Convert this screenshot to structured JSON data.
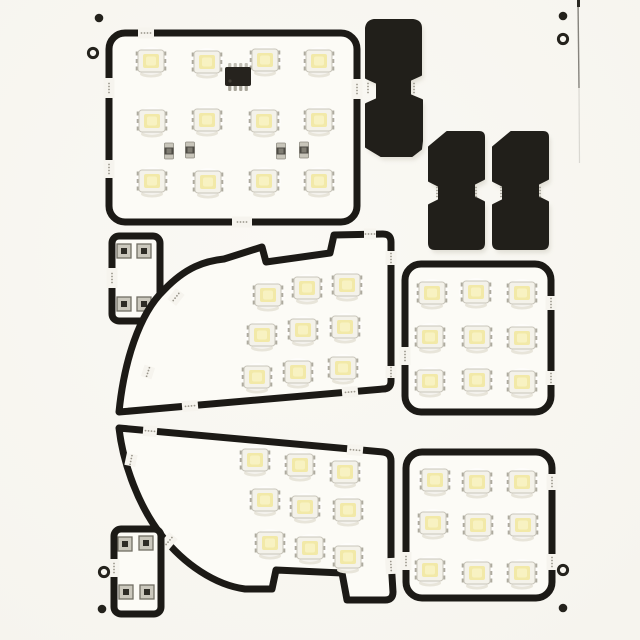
{
  "image": {
    "kind": "product-photo",
    "caption": "White snap-apart PCB panel of car interior LED light boards: black outline traces, white SMD 5050 LEDs with pale yellow phosphor, driver IC, resistors, black festoon adapters and fiducial marks",
    "led_total": 48
  },
  "palette": {
    "background": "#f6f4ee",
    "background_hi": "#faf9f4",
    "board_surface": "#fcfbf6",
    "outline": "#1c1a16",
    "solid_piece": "#211f1a",
    "led_body": "#f4f2ea",
    "led_border": "#c9c6bb",
    "led_phosphor": "#f2e9a8",
    "led_phosphor_hi": "#f8f2c2",
    "led_pad": "#aeab9f",
    "led_shadow": "#e8e5da",
    "ic_body": "#26231e",
    "pin_metal": "#a8a59a",
    "resistor_cap": "#c8c5ba",
    "resistor_body": "#4e4c45",
    "resistor_dot": "#807d73",
    "pad_face": "#cbc8bd",
    "pad_edge": "#716e64",
    "pad_center": "#2e2c26",
    "bite_dot": "#9a968b",
    "fiducial": "#24221c",
    "shadow_soft": "#dcd9cf",
    "edge_line": "#55534c"
  },
  "scene": {
    "width": 640,
    "height": 640,
    "boards": [
      {
        "id": "map-light-board",
        "rect": [
          109,
          33,
          248,
          189,
          16
        ],
        "breaks": [
          [
            146,
            33,
            0,
            16
          ],
          [
            109,
            88,
            90,
            20
          ],
          [
            109,
            169,
            90,
            18
          ],
          [
            242,
            222,
            0,
            20
          ],
          [
            357,
            89,
            90,
            20
          ]
        ],
        "leds": [
          [
            151,
            61
          ],
          [
            207,
            62
          ],
          [
            265,
            60
          ],
          [
            319,
            61
          ],
          [
            152,
            121
          ],
          [
            207,
            120
          ],
          [
            264,
            121
          ],
          [
            319,
            120
          ],
          [
            152,
            181
          ],
          [
            208,
            182
          ],
          [
            264,
            181
          ],
          [
            319,
            181
          ]
        ],
        "ics": [
          [
            238,
            77
          ]
        ],
        "resistors": [
          [
            169,
            151
          ],
          [
            190,
            150
          ],
          [
            281,
            151
          ],
          [
            304,
            150
          ]
        ]
      },
      {
        "id": "jumper-board-top",
        "rect": [
          112,
          236,
          48,
          85,
          7
        ],
        "breaks": [
          [
            112,
            278,
            90,
            20
          ]
        ],
        "pads": [
          [
            124,
            251
          ],
          [
            144,
            251
          ],
          [
            124,
            304
          ],
          [
            144,
            304
          ]
        ]
      },
      {
        "id": "dome-board-upper",
        "path": "M 119,412 C 124,362 139,314 164,290 C 186,267 205,261 224,259 L 262,247 L 266,262 L 330,253 L 334,235 L 383,234 Q 391,234 391,242 L 391,381 Q 391,389 383,389 Z",
        "breaks": [
          [
            176,
            297,
            -52,
            14
          ],
          [
            148,
            372,
            -72,
            12
          ],
          [
            190,
            406,
            -5,
            16
          ],
          [
            350,
            392,
            -5,
            16
          ],
          [
            391,
            258,
            90,
            14
          ],
          [
            391,
            372,
            90,
            12
          ],
          [
            370,
            234,
            0,
            12
          ]
        ],
        "leds": [
          [
            268,
            295
          ],
          [
            307,
            288
          ],
          [
            347,
            285
          ],
          [
            262,
            335
          ],
          [
            303,
            330
          ],
          [
            345,
            327
          ],
          [
            257,
            377
          ],
          [
            298,
            372
          ],
          [
            343,
            368
          ]
        ]
      },
      {
        "id": "dome-board-lower",
        "path": "M 119,428 L 383,452 Q 391,453 391,461 L 391,560 L 393,592 Q 393,600 385,600 L 347,600 L 342,573 L 276,570 L 272,589 L 245,589 C 215,585 184,564 162,536 C 139,507 123,464 119,428 Z",
        "breaks": [
          [
            150,
            431,
            5,
            14
          ],
          [
            355,
            450,
            5,
            16
          ],
          [
            391,
            566,
            87,
            16
          ],
          [
            169,
            541,
            -50,
            14
          ],
          [
            131,
            460,
            -78,
            12
          ]
        ],
        "leds": [
          [
            255,
            460
          ],
          [
            300,
            465
          ],
          [
            345,
            472
          ],
          [
            265,
            500
          ],
          [
            305,
            507
          ],
          [
            348,
            510
          ],
          [
            270,
            543
          ],
          [
            310,
            548
          ],
          [
            348,
            557
          ]
        ]
      },
      {
        "id": "square-led-board-right",
        "rect": [
          405,
          264,
          146,
          148,
          16
        ],
        "breaks": [
          [
            405,
            356,
            90,
            18
          ],
          [
            551,
            303,
            90,
            14
          ],
          [
            551,
            378,
            90,
            14
          ]
        ],
        "leds": [
          [
            432,
            293
          ],
          [
            476,
            292
          ],
          [
            522,
            293
          ],
          [
            430,
            337
          ],
          [
            477,
            337
          ],
          [
            522,
            338
          ],
          [
            430,
            381
          ],
          [
            477,
            380
          ],
          [
            522,
            382
          ]
        ]
      },
      {
        "id": "square-led-board-bottom-right",
        "rect": [
          406,
          452,
          146,
          146,
          16
        ],
        "breaks": [
          [
            406,
            561,
            90,
            18
          ],
          [
            552,
            482,
            90,
            16
          ],
          [
            552,
            562,
            90,
            16
          ]
        ],
        "leds": [
          [
            435,
            480
          ],
          [
            477,
            482
          ],
          [
            522,
            482
          ],
          [
            433,
            523
          ],
          [
            478,
            525
          ],
          [
            523,
            525
          ],
          [
            430,
            570
          ],
          [
            477,
            573
          ],
          [
            522,
            573
          ]
        ]
      },
      {
        "id": "jumper-board-bottom",
        "rect": [
          114,
          529,
          47,
          85,
          7
        ],
        "breaks": [
          [
            114,
            568,
            90,
            18
          ]
        ],
        "pads": [
          [
            125,
            544
          ],
          [
            146,
            543
          ],
          [
            126,
            592
          ],
          [
            147,
            592
          ]
        ]
      }
    ],
    "solid_pieces": [
      {
        "id": "festoon-adapter-top",
        "path": "M 374,20 L 413,20 Q 421,21 421,28 L 421,75 L 410,80 L 410,95 L 422,100 L 422,141 L 421,149 L 412,156 L 381,156 L 366,147 L 366,104 L 377,99 L 377,83 L 366,78 L 366,28 Q 367,21 374,20 Z",
        "bites": [
          [
            368,
            88,
            90
          ],
          [
            414,
            88,
            90
          ]
        ]
      },
      {
        "id": "wedge-adapter-left",
        "path": "M 447,132 L 479,132 Q 484,132 484,137 L 484,179 L 474,184 L 474,197 L 484,202 L 484,243 Q 484,249 478,249 L 435,249 Q 429,249 429,243 L 429,205 L 439,200 L 439,186 L 429,181 L 429,147 Z",
        "bites": [
          [
            437,
            192,
            90
          ],
          [
            476,
            192,
            90
          ]
        ]
      },
      {
        "id": "wedge-adapter-right",
        "path": "M 511,132 L 543,132 Q 548,132 548,137 L 548,179 L 538,184 L 538,197 L 548,202 L 548,243 Q 548,249 542,249 L 499,249 Q 493,249 493,243 L 493,205 L 503,200 L 503,186 L 493,181 L 493,147 Z",
        "bites": [
          [
            501,
            192,
            90
          ],
          [
            540,
            192,
            90
          ]
        ]
      }
    ],
    "fiducials": {
      "solid": [
        [
          99,
          18
        ],
        [
          563,
          16
        ],
        [
          102,
          609
        ],
        [
          563,
          608
        ]
      ],
      "ring": [
        [
          93,
          53
        ],
        [
          563,
          39
        ],
        [
          104,
          572
        ],
        [
          563,
          570
        ]
      ]
    },
    "edge_marks": {
      "line_x": 578,
      "line_y1": 0,
      "line_y2": 88
    }
  }
}
